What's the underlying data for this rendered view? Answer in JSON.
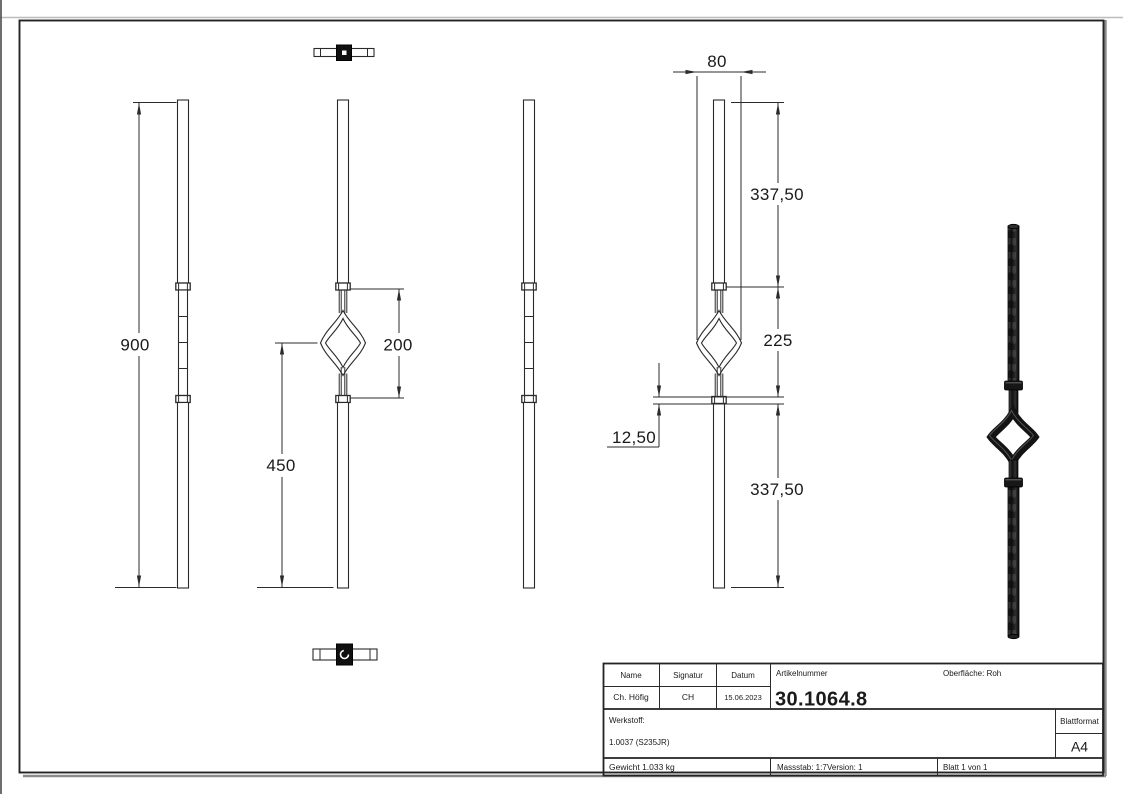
{
  "colors": {
    "line": "#2b2b2b",
    "render_dark": "#1c1c1c",
    "sheet_shadow": "#8a8a8a",
    "background": "#ffffff"
  },
  "dimensions": {
    "overall_length": "900",
    "lower_half": "450",
    "ornament_length": "200",
    "ornament_width": "80",
    "top_section": "337,50",
    "center_section": "225",
    "collar_height": "12,50",
    "bottom_section": "337,50"
  },
  "title_block": {
    "name_label": "Name",
    "name_value": "Ch. Höfig",
    "signatur_label": "Signatur",
    "signatur_value": "CH",
    "datum_label": "Datum",
    "datum_value": "15.06.2023",
    "artikelnummer_label": "Artikelnummer",
    "artikelnummer_value": "30.1064.8",
    "oberflaeche": "Oberfläche:  Roh",
    "werkstoff_label": "Werkstoff:",
    "werkstoff_value": "1.0037 (S235JR)",
    "blattformat_label": "Blattformat",
    "blattformat_value": "A4",
    "gewicht": "Gewicht 1.033 kg",
    "massstab": "Massstab: 1:7",
    "version": "Version: 1",
    "blatt": "Blatt 1 von 1"
  }
}
